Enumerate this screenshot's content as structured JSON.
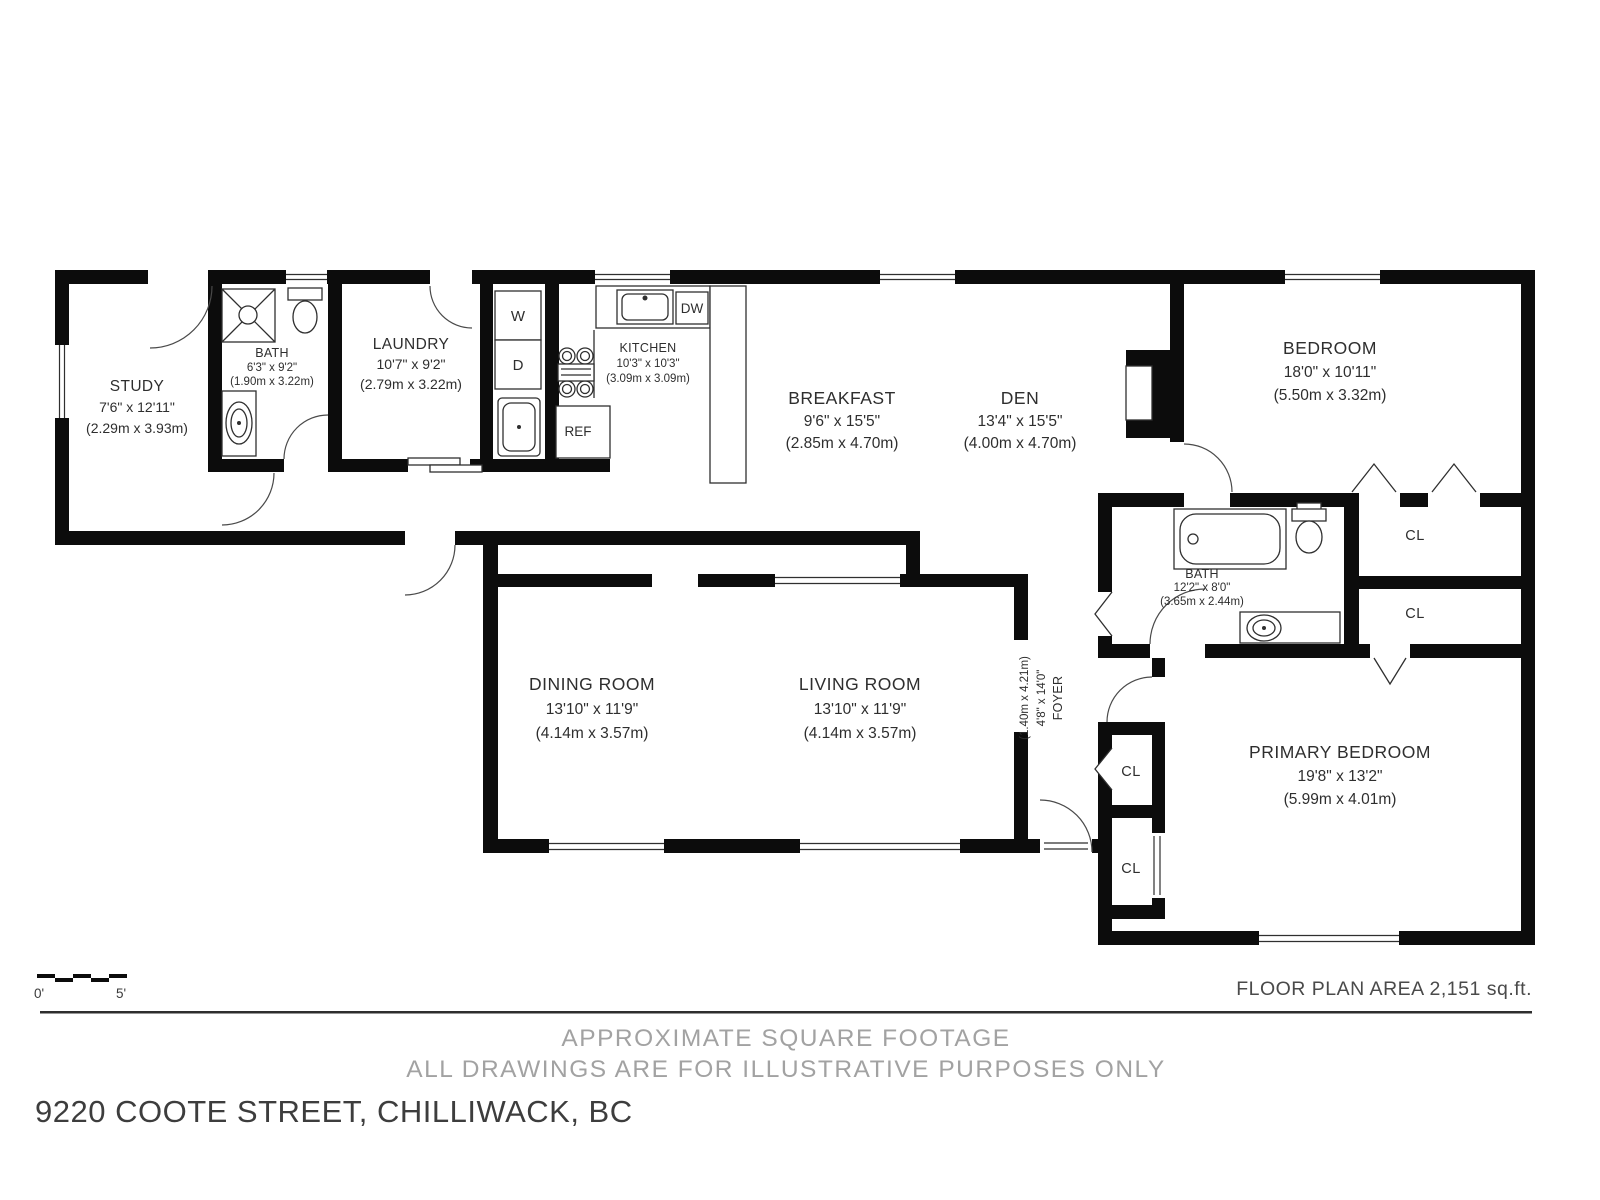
{
  "plan": {
    "rooms": [
      {
        "id": "study",
        "name": "STUDY",
        "dims_ft": "7'6\" x 12'11\"",
        "dims_m": "(2.29m x 3.93m)"
      },
      {
        "id": "bath-main-floor",
        "name": "BATH",
        "dims_ft": "6'3\" x 9'2\"",
        "dims_m": "(1.90m x 3.22m)"
      },
      {
        "id": "laundry",
        "name": "LAUNDRY",
        "dims_ft": "10'7\" x 9'2\"",
        "dims_m": "(2.79m x 3.22m)"
      },
      {
        "id": "kitchen",
        "name": "KITCHEN",
        "dims_ft": "10'3\" x 10'3\"",
        "dims_m": "(3.09m x 3.09m)"
      },
      {
        "id": "breakfast",
        "name": "BREAKFAST",
        "dims_ft": "9'6\" x 15'5\"",
        "dims_m": "(2.85m x 4.70m)"
      },
      {
        "id": "den",
        "name": "DEN",
        "dims_ft": "13'4\" x 15'5\"",
        "dims_m": "(4.00m x 4.70m)"
      },
      {
        "id": "bedroom",
        "name": "BEDROOM",
        "dims_ft": "18'0\" x 10'11\"",
        "dims_m": "(5.50m x 3.32m)"
      },
      {
        "id": "bath-bedroom-wing",
        "name": "BATH",
        "dims_ft": "12'2\" x 8'0\"",
        "dims_m": "(3.65m x 2.44m)"
      },
      {
        "id": "dining-room",
        "name": "DINING ROOM",
        "dims_ft": "13'10\" x 11'9\"",
        "dims_m": "(4.14m x 3.57m)"
      },
      {
        "id": "living-room",
        "name": "LIVING ROOM",
        "dims_ft": "13'10\" x 11'9\"",
        "dims_m": "(4.14m x 3.57m)"
      },
      {
        "id": "foyer",
        "name": "FOYER",
        "dims_ft": "4'8\" x 14'0\"",
        "dims_m": "(1.40m x 4.21m)"
      },
      {
        "id": "primary-bedroom",
        "name": "PRIMARY BEDROOM",
        "dims_ft": "19'8\" x 13'2\"",
        "dims_m": "(5.99m x 4.01m)"
      }
    ],
    "closets": [
      "CL",
      "CL",
      "CL",
      "CL"
    ],
    "appliances": {
      "washer": "W",
      "dryer": "D",
      "dishwasher": "DW",
      "refrigerator": "REF"
    }
  },
  "scale_bar": {
    "start": "0'",
    "end": "5'"
  },
  "footer": {
    "area_label": "FLOOR PLAN AREA 2,151 sq.ft.",
    "disclaimer_line1": "APPROXIMATE SQUARE FOOTAGE",
    "disclaimer_line2": "ALL DRAWINGS ARE FOR ILLUSTRATIVE PURPOSES ONLY",
    "address": "9220 COOTE STREET, CHILLIWACK, BC"
  },
  "colors": {
    "wall": "#0c0c0c",
    "line": "#2f2f2f",
    "muted": "#a2a2a2",
    "footer_text": "#3d3d3d",
    "label": "#2e2e2e"
  }
}
